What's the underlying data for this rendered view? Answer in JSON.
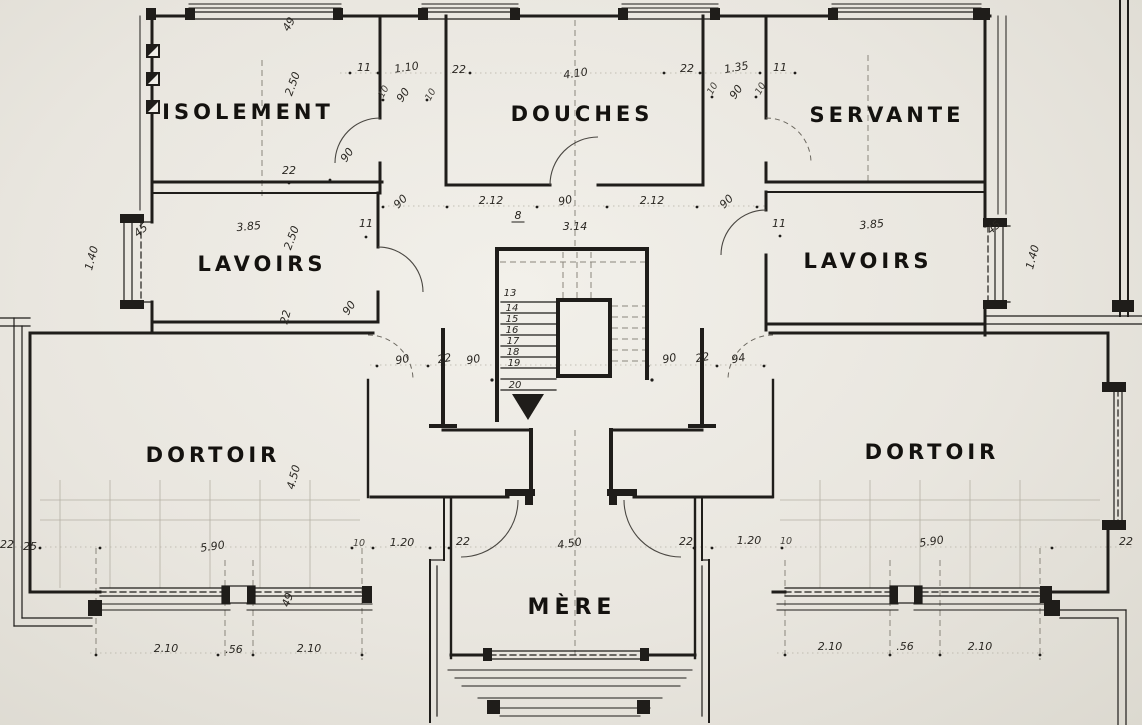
{
  "drawing_type": "floor-plan",
  "language": "French",
  "colors": {
    "paper": "#e9e6df",
    "ink": "#1f1d1a",
    "pencil": "#8a867c"
  },
  "rooms": [
    {
      "id": "isolement",
      "label": "ISOLEMENT"
    },
    {
      "id": "douches",
      "label": "DOUCHES"
    },
    {
      "id": "servante",
      "label": "SERVANTE"
    },
    {
      "id": "lavoirs_left",
      "label": "LAVOIRS"
    },
    {
      "id": "lavoirs_right",
      "label": "LAVOIRS"
    },
    {
      "id": "dortoir_left",
      "label": "DORTOIR"
    },
    {
      "id": "dortoir_right",
      "label": "DORTOIR"
    },
    {
      "id": "mere",
      "label": "MÈRE"
    }
  ],
  "stair": {
    "steps": [
      "13",
      "14",
      "15",
      "16",
      "17",
      "18",
      "19",
      "20"
    ],
    "direction": "down"
  },
  "dims": [
    "49",
    "2.50",
    "11",
    "1.10",
    "22",
    "4.10",
    "22",
    "1.35",
    "11",
    "10",
    "90",
    "10",
    "10",
    "90",
    "10",
    "22",
    "90",
    "90",
    "2.12",
    "8",
    "90",
    "2.12",
    "90",
    "3.14",
    "45",
    "1.40",
    "3.85",
    "2.50",
    "11",
    "11",
    "3.85",
    "45",
    "1.40",
    "22",
    "90",
    "90",
    "22",
    "90",
    "90",
    "22",
    "94",
    "4.50",
    "5.90",
    "10",
    "1.20",
    "22",
    "4.50",
    "22",
    "1.20",
    "10",
    "5.90",
    "22",
    "22",
    "25",
    "49",
    "2.10",
    ".56",
    "2.10",
    "2.10",
    ".56",
    "2.10"
  ]
}
